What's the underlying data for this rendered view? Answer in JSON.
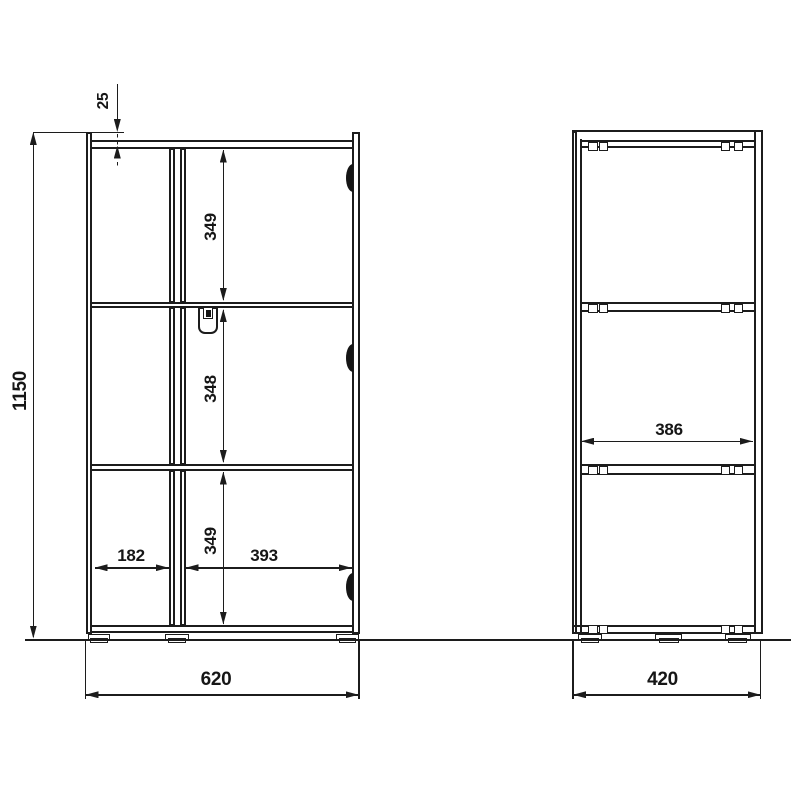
{
  "dimensions": {
    "overall_height": "1150",
    "top_panel_offset": "25",
    "compartment_top": "349",
    "compartment_middle": "348",
    "compartment_bottom": "349",
    "left_section_width": "182",
    "right_section_width": "393",
    "overall_width": "620",
    "inner_depth": "386",
    "overall_depth": "420"
  },
  "icons": {
    "hinge": "hinge-marker",
    "connector": "cam-connector",
    "foot": "adjustable-foot",
    "handle": "door-handle"
  },
  "colors": {
    "line": "#1c1c1c",
    "background": "#ffffff"
  }
}
